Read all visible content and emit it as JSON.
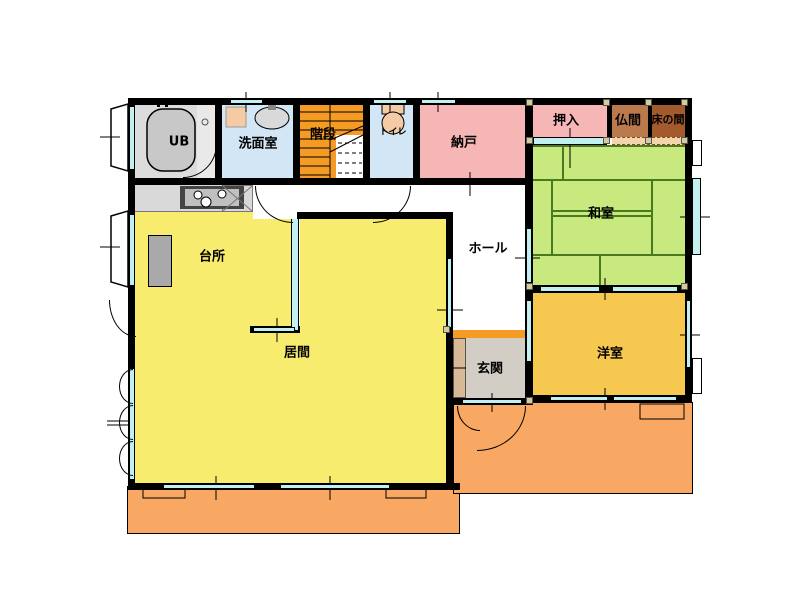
{
  "plan": {
    "type": "japanese-house-floor-plan",
    "rooms": {
      "ub": {
        "label": "UB"
      },
      "senmen": {
        "label": "洗面室"
      },
      "kaidan": {
        "label": "階段"
      },
      "toire": {
        "label": "トイレ"
      },
      "nando": {
        "label": "納戸"
      },
      "oshiire": {
        "label": "押入"
      },
      "butsuma": {
        "label": "仏間"
      },
      "tokonoma": {
        "label": "床の間"
      },
      "washitsu": {
        "label": "和室"
      },
      "hall": {
        "label": "ホール"
      },
      "daidokoro": {
        "label": "台所"
      },
      "ima": {
        "label": "居間"
      },
      "genkan": {
        "label": "玄関"
      },
      "youshitsu": {
        "label": "洋室"
      }
    },
    "colors": {
      "wall": "#000000",
      "window_cyan": "#C2F0F0",
      "tatami_green": "#C8E97E",
      "tatami_line": "#4A7A1F",
      "room_yellow": "#F7EC6E",
      "western_gold": "#F7C850",
      "storage_pink": "#F7B6B6",
      "stairs_orange": "#F59B23",
      "veranda_orange": "#F9A863",
      "wet_area_blue": "#D2E6F5",
      "butsuma_brown": "#BA7A4D",
      "tokonoma_brown": "#A35B2E",
      "genkan_gray": "#D2CEC6",
      "shoe_cabinet_tan": "#D9B896",
      "fixture_gray": "#D9D9D9",
      "hall_white": "#FFFFFF"
    }
  }
}
